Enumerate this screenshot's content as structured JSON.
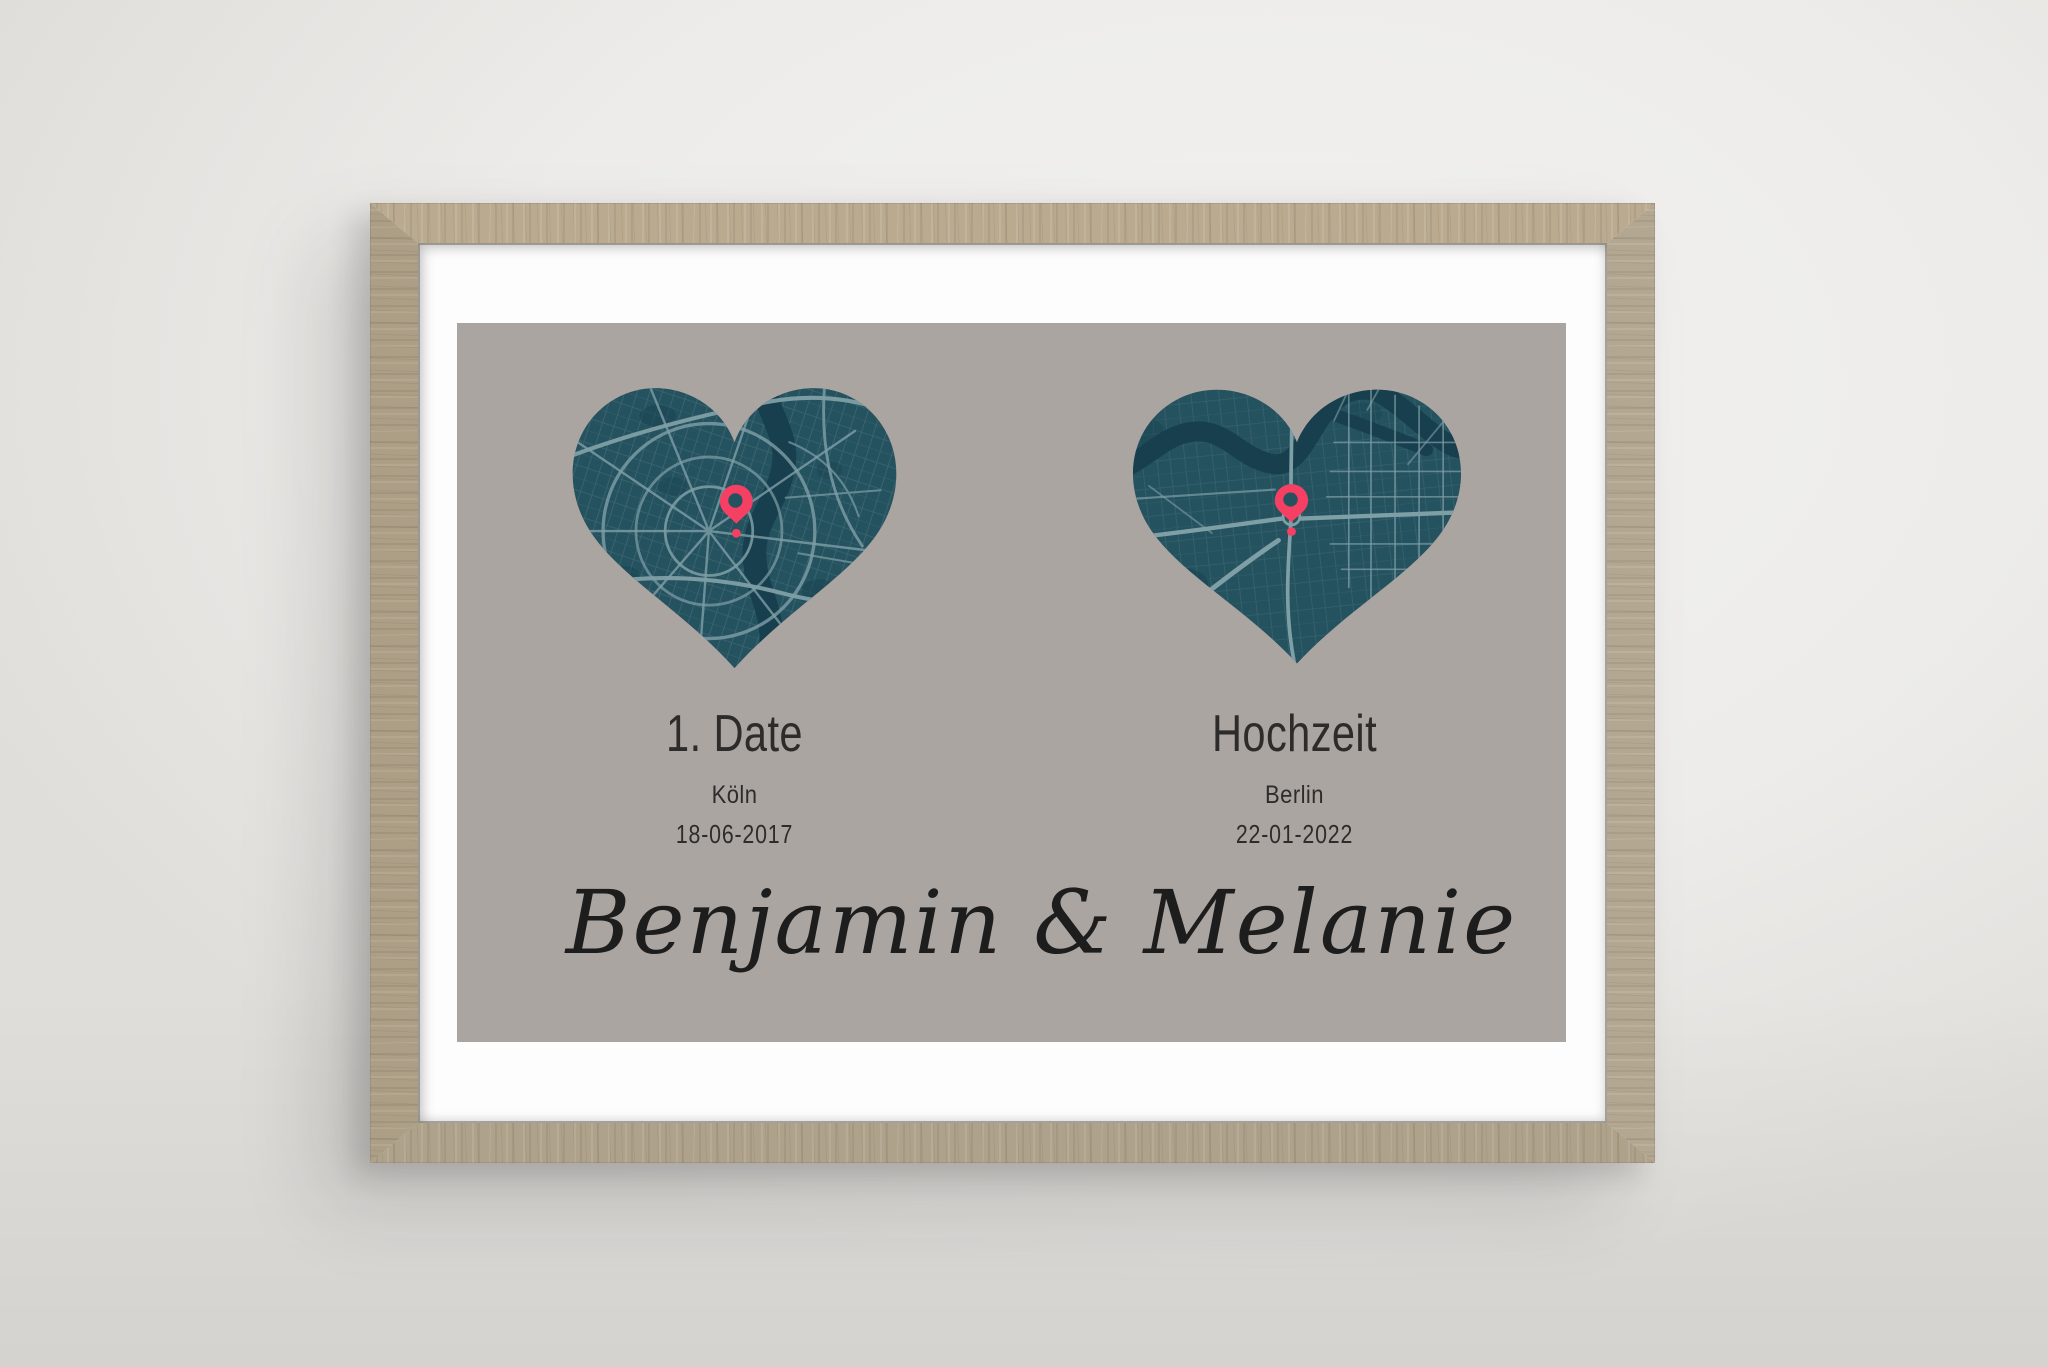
{
  "colors": {
    "wall": "#edecea",
    "wood": "#b6a78d",
    "mat": "#fdfdfd",
    "poster-bg": "#aba5a2",
    "map-base": "#25525f",
    "map-water": "#173f4d",
    "road-main": "#7f9fa7",
    "road-minor": "#5b828d",
    "pin": "#f53f63",
    "ink": "#2e2c2b",
    "script-ink": "#1d1d1d"
  },
  "poster": {
    "left": {
      "title": "1. Date",
      "city": "Köln",
      "date": "18-06-2017"
    },
    "right": {
      "title": "Hochzeit",
      "city": "Berlin",
      "date": "22-01-2022"
    },
    "names": "Benjamin & Melanie"
  }
}
